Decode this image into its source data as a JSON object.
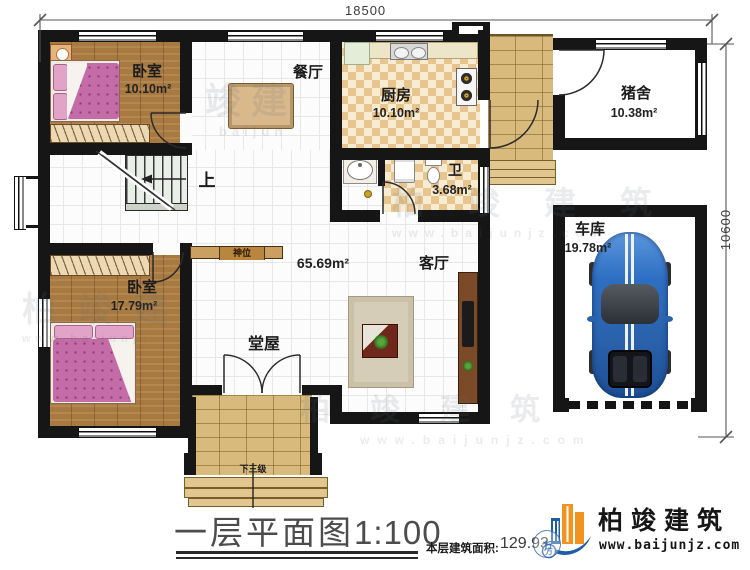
{
  "dimensions": {
    "width_label": "18500",
    "height_label": "10600"
  },
  "rooms": {
    "bedroom1": {
      "name": "卧室",
      "area": "10.10m²"
    },
    "dining": {
      "name": "餐厅"
    },
    "kitchen": {
      "name": "厨房",
      "area": "10.10m²"
    },
    "pigpen": {
      "name": "猪舍",
      "area": "10.38m²"
    },
    "bath": {
      "name": "卫",
      "area": "3.68m²"
    },
    "hall": {
      "name": "堂屋",
      "area": "65.69m²"
    },
    "living": {
      "name": "客厅"
    },
    "bedroom2": {
      "name": "卧室",
      "area": "17.79m²"
    },
    "garage": {
      "name": "车库",
      "area": "19.78m²"
    }
  },
  "annotations": {
    "stairs_up": "上",
    "shrine": "神位",
    "steps_down": "下三级"
  },
  "watermarks": [
    {
      "text": "竣建",
      "url": "baijun"
    },
    {
      "text": "柏竣建筑",
      "url": "www.baijunjz.com"
    },
    {
      "text": "柏竣建",
      "url": "www.baijunjz"
    },
    {
      "text": "柏竣建筑",
      "url": "www.baijunjz.com"
    }
  ],
  "footer": {
    "title": "一层平面图",
    "scale": "1:100",
    "area_label": "本层建筑面积:",
    "area_value": "129.93",
    "stamp": "方"
  },
  "brand": {
    "name": "柏竣建筑",
    "website": "www.baijunjz.com"
  },
  "colors": {
    "wall": "#161616",
    "wood": "#a87a42",
    "bed_pink": "#c36ca8",
    "checker_tan": "#e8c48e",
    "brick": "#d9ba7d",
    "car_blue": "#2e6fc3",
    "logo_blue": "#1f5ca8",
    "logo_orange": "#f0941f"
  }
}
